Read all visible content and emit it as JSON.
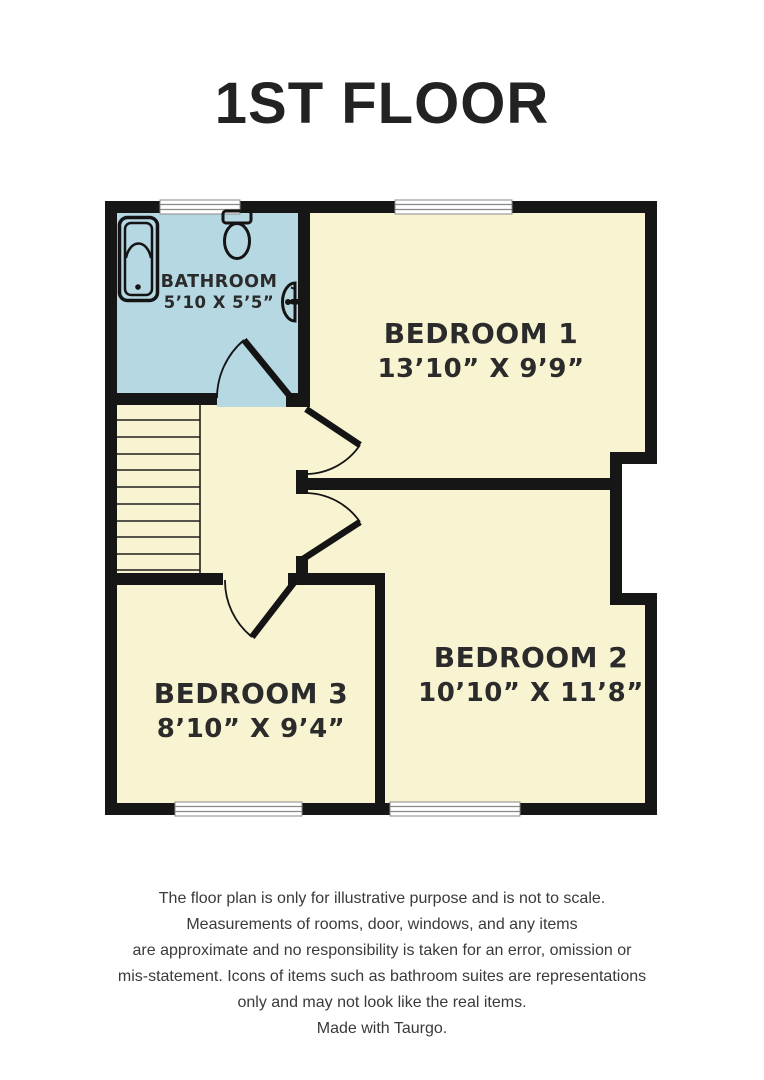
{
  "title": "1ST FLOOR",
  "rooms": {
    "bathroom": {
      "name": "BATHROOM",
      "dims": "5’10 X 5’5”"
    },
    "bedroom1": {
      "name": "BEDROOM 1",
      "dims": "13’10” X 9’9”"
    },
    "bedroom2": {
      "name": "BEDROOM 2",
      "dims": "10’10” X 11’8”"
    },
    "bedroom3": {
      "name": "BEDROOM 3",
      "dims": "8’10” X 9’4”"
    }
  },
  "fixtures": {
    "bathtub": "bathtub-icon",
    "toilet": "toilet-icon",
    "sink": "sink-icon",
    "stairs": "stairs",
    "windows": "window",
    "doors": "door-swing"
  },
  "disclaimer": {
    "lines": [
      "The floor plan is only for illustrative purpose and is not to scale.",
      "Measurements of rooms, door, windows, and any items",
      "are approximate and no responsibility is taken for an error, omission or",
      "mis-statement. Icons of items such as bathroom suites are representations",
      "only and may not look like the real items.",
      "Made with Taurgo."
    ]
  },
  "colors": {
    "room_fill": "#f8f4d1",
    "bathroom_fill": "#b5d8e3",
    "wall": "#161616",
    "label_text": "#2b2b2b"
  }
}
